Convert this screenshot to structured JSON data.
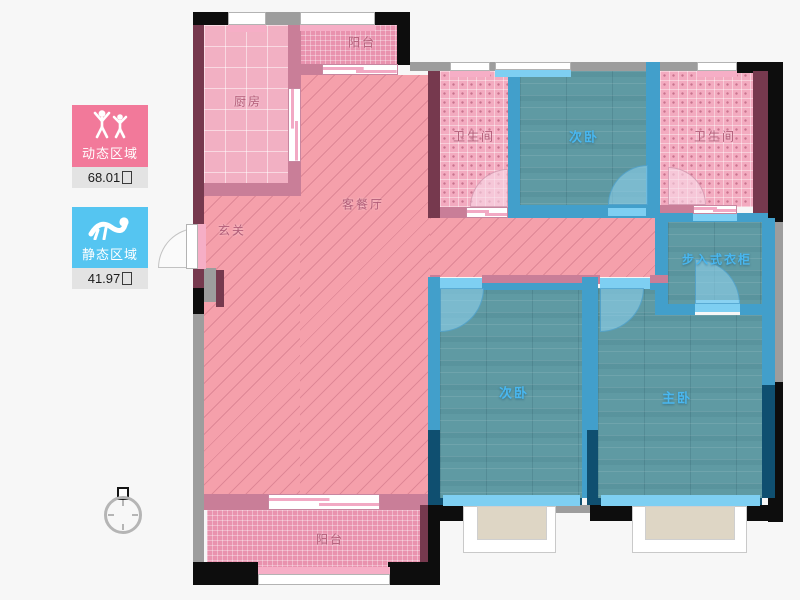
{
  "legend": {
    "dynamic": {
      "label": "动态区域",
      "area": "68.01",
      "unit": "㎡"
    },
    "static": {
      "label": "静态区域",
      "area": "41.97",
      "unit": "㎡"
    }
  },
  "rooms": {
    "balcony_top": {
      "label": "阳台"
    },
    "kitchen": {
      "label": "厨房"
    },
    "living": {
      "label": "客餐厅"
    },
    "entry": {
      "label": "玄关"
    },
    "bath_left": {
      "label": "卫生间"
    },
    "bedroom_top": {
      "label": "次卧"
    },
    "bath_right": {
      "label": "卫生间"
    },
    "closet": {
      "label": "步入式衣柜"
    },
    "bedroom_bottom": {
      "label": "次卧"
    },
    "master": {
      "label": "主卧"
    },
    "balcony_bottom": {
      "label": "阳台"
    }
  },
  "colors": {
    "dynamic": "#f2799a",
    "static": "#55c5f1",
    "pink-floor": "#f5a0ab",
    "pink-wall": "#c97e98",
    "dark-red-wall": "#76394e",
    "teal-floor": "#5f9aa3",
    "blue-wall": "#429fcb",
    "navy-wall": "#0f4f70",
    "light-blue-band": "#7ecff2"
  },
  "icons": {
    "dynamic_icon": "people-active-icon",
    "static_icon": "person-resting-icon",
    "compass": "north-indicator-icon"
  }
}
